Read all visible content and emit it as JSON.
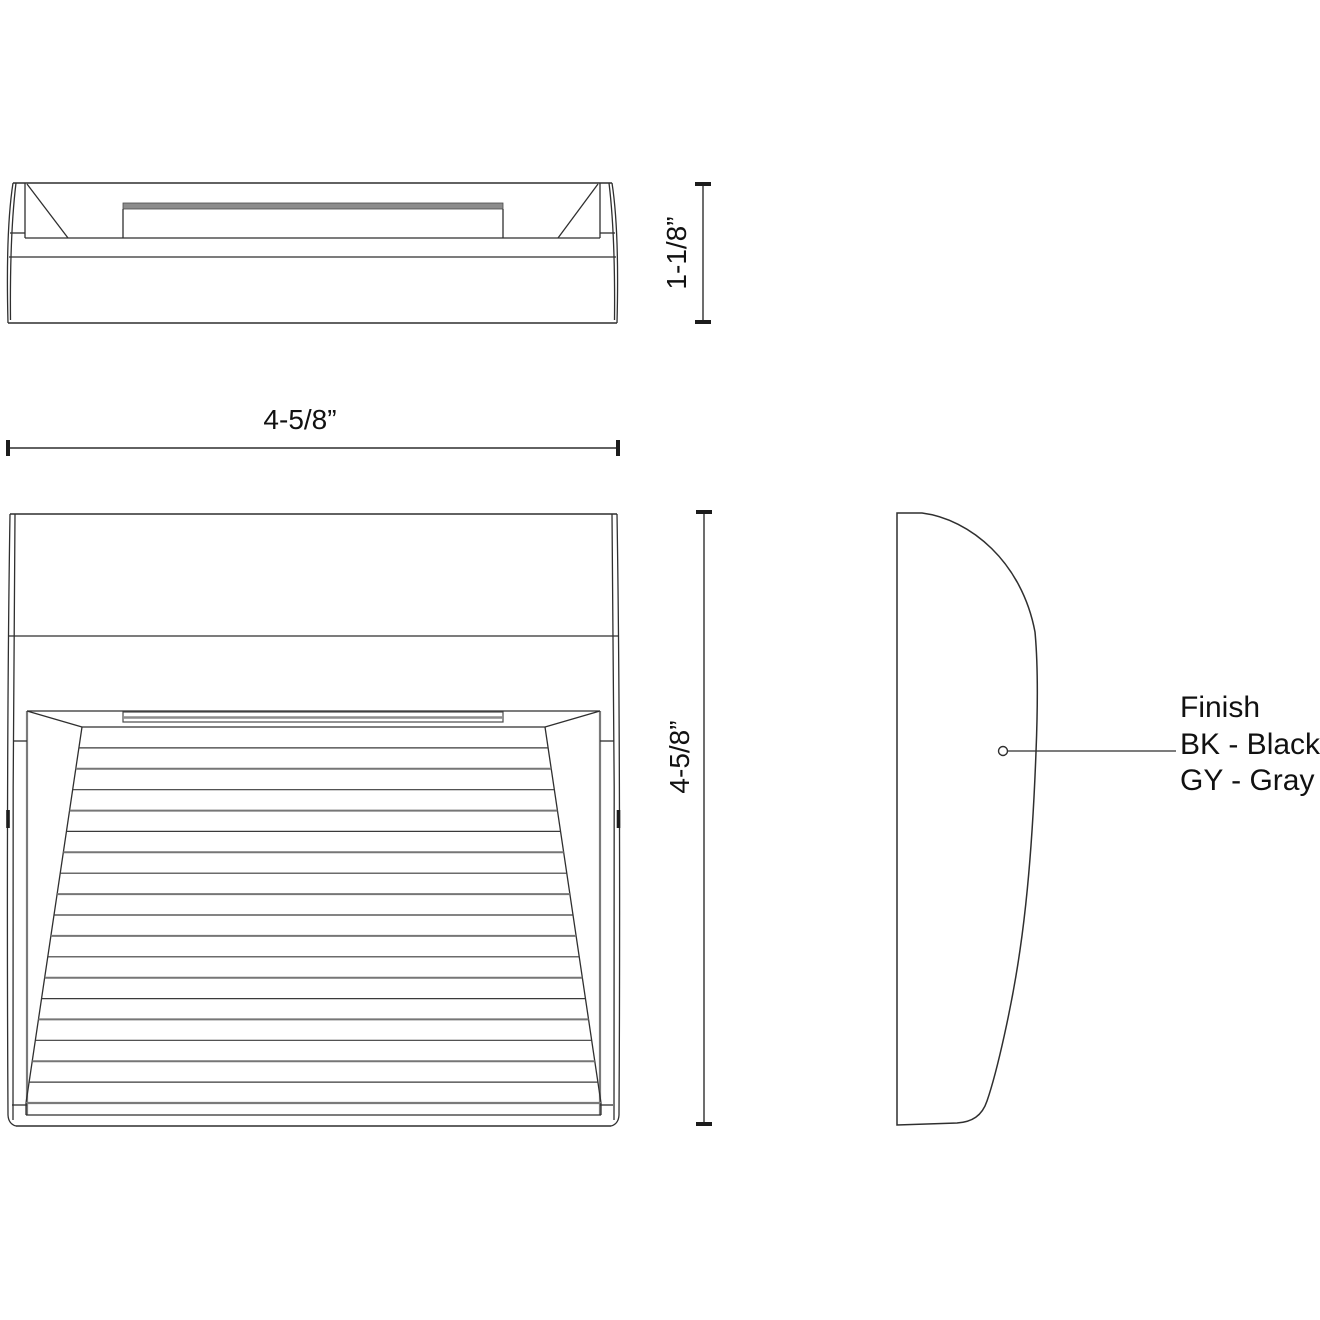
{
  "top_view": {
    "depth_dimension": "1-1/8”"
  },
  "front_view": {
    "width_dimension": "4-5/8”",
    "height_dimension": "4-5/8”",
    "louver_line_count": 17
  },
  "side_view": {
    "finish": {
      "title": "Finish",
      "options": [
        "BK - Black",
        "GY - Gray"
      ]
    }
  }
}
